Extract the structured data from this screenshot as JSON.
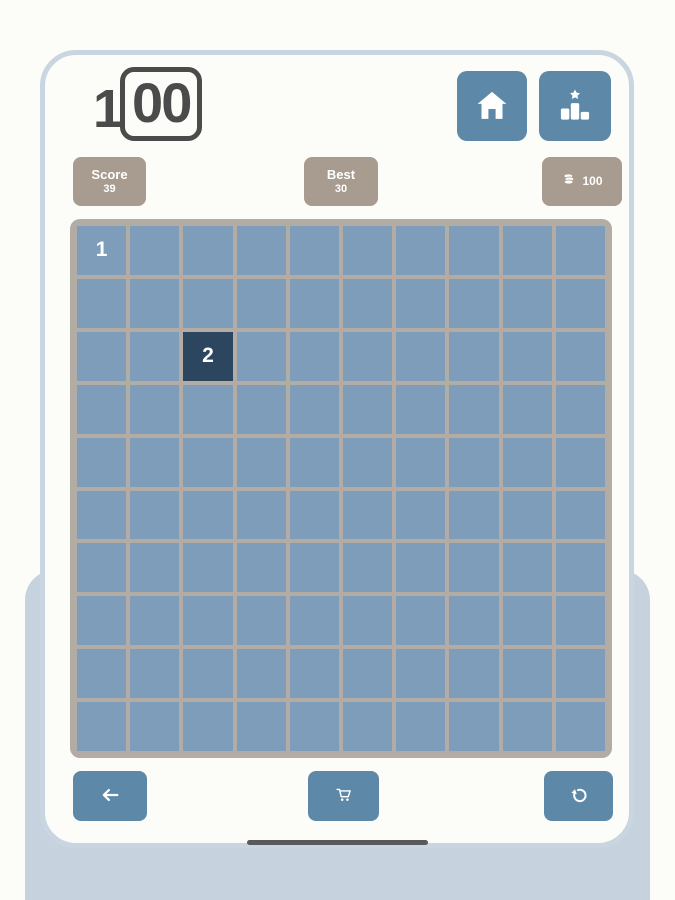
{
  "app_title": "100",
  "logo": {
    "outside_digit": "1",
    "boxed_digits": "00"
  },
  "header": {
    "home_button": {
      "icon": "home-icon"
    },
    "leaderboard_button": {
      "icon": "podium-star-icon"
    }
  },
  "stats": {
    "score": {
      "label": "Score",
      "value": "39"
    },
    "best": {
      "label": "Best",
      "value": "30"
    },
    "coins": {
      "icon": "coins-icon",
      "value": "100"
    }
  },
  "board": {
    "rows": 10,
    "cols": 10,
    "filled_cells": [
      {
        "row": 0,
        "col": 0,
        "value": "1",
        "style": "normal"
      },
      {
        "row": 2,
        "col": 2,
        "value": "2",
        "style": "dark"
      }
    ]
  },
  "footer": {
    "back_button": {
      "icon": "arrow-left-icon"
    },
    "shop_button": {
      "icon": "cart-icon"
    },
    "undo_button": {
      "icon": "undo-icon"
    }
  },
  "colors": {
    "accent_blue": "#5e88a8",
    "cell_blue": "#7d9dba",
    "cell_dark": "#2d4660",
    "grid_line": "#b2aca4",
    "badge_tan": "#a89b90",
    "frame_blue": "#c9d6e1",
    "panel_blue": "#c6d3de",
    "page_bg": "#fcfcf8",
    "logo_gray": "#4b4b4b",
    "cell_text": "#ffffff"
  }
}
